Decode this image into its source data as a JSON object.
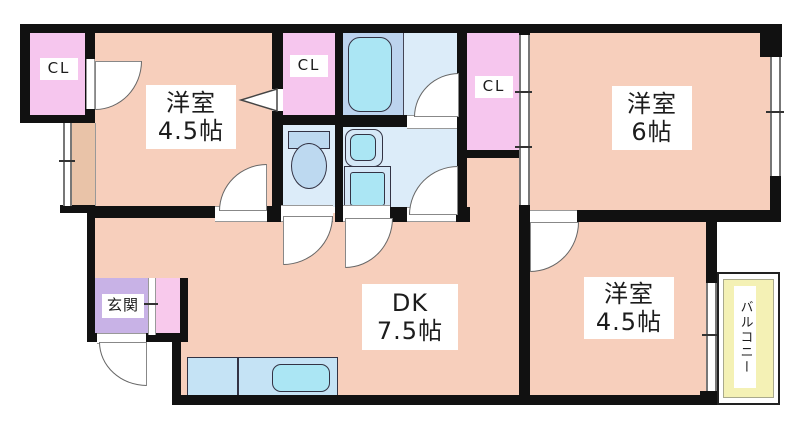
{
  "labels": {
    "closet1": "CL",
    "closet2": "CL",
    "closet3": "CL",
    "room1": {
      "name": "洋室",
      "size": "4.5帖"
    },
    "room2": {
      "name": "洋室",
      "size": "6帖"
    },
    "room3": {
      "name": "洋室",
      "size": "4.5帖"
    },
    "dk": {
      "name": "DK",
      "size": "7.5帖"
    },
    "genkan": "玄関",
    "balcony": "バルコニー"
  },
  "palette": {
    "wall": "#111111",
    "room_floor": "#f7cfbc",
    "bay_tan": "#e9c3a8",
    "closet_pink": "#f6c6ee",
    "genkan_purple": "#c8b2e6",
    "shoe_pink": "#f8c9ec",
    "bathroom_blue": "#bcd3ee",
    "wetroom_blue": "#dcecf9",
    "fixture_cyan": "#abe6f4",
    "counter_blue": "#c5e3f5",
    "balcony_yellow": "#f4f1b5"
  }
}
